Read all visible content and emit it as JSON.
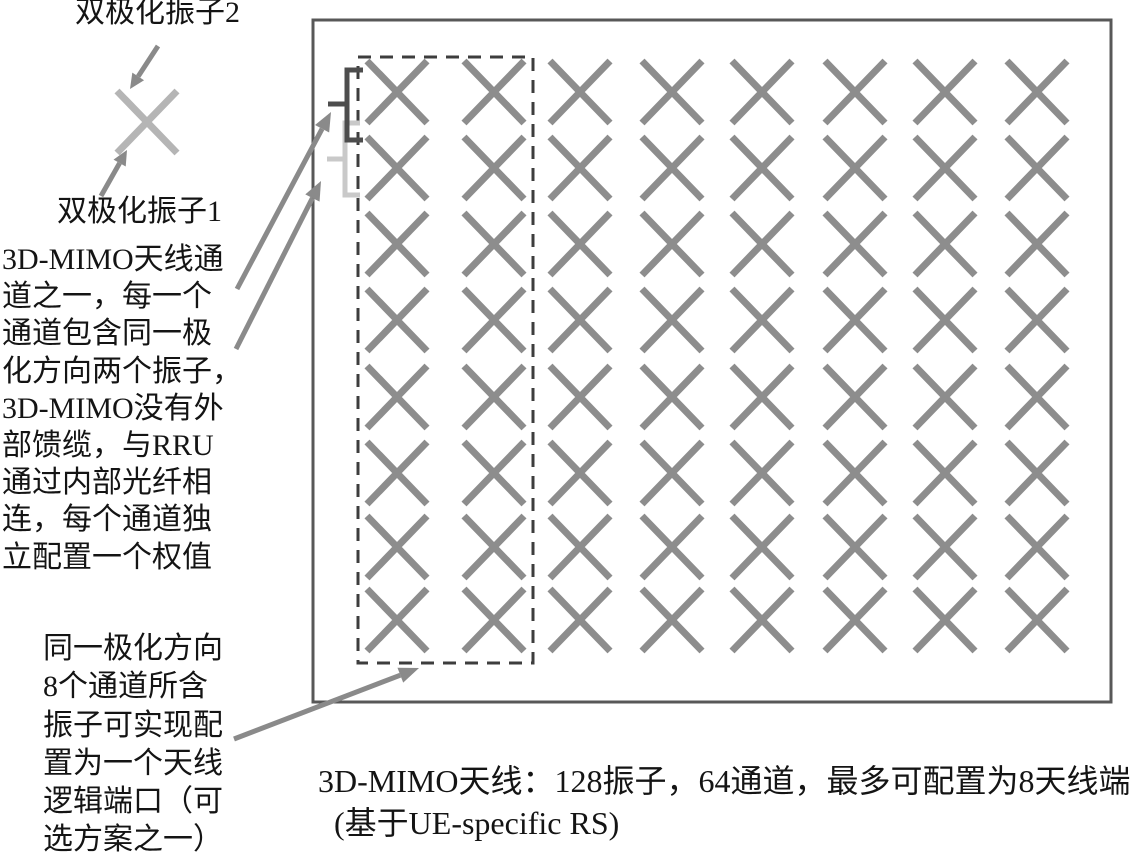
{
  "colors": {
    "text": "#141414",
    "panel_border": "#585858",
    "dashed_box": "#3d3d3d",
    "element_x": "#8d8d8d",
    "legend_x": "#b5b5b5",
    "arrow": "#8a8a8a",
    "bracket_dark": "#4d4d4d",
    "bracket_light": "#c9c9c9"
  },
  "legend": {
    "element2_label": "双极化振子2",
    "element1_label": "双极化振子1"
  },
  "left_note": {
    "lines": [
      "3D-MIMO天线通",
      "道之一，每一个",
      "通道包含同一极",
      "化方向两个振子，",
      "3D-MIMO没有外",
      "部馈缆，与RRU",
      "通过内部光纤相",
      "连，每个通道独",
      "立配置一个权值"
    ]
  },
  "bottom_left_note": {
    "lines": [
      "同一极化方向",
      "8个通道所含",
      "振子可实现配",
      "置为一个天线",
      "逻辑端口（可",
      "选方案之一）"
    ]
  },
  "caption": {
    "line1": "3D-MIMO天线：128振子，64通道，最多可配置为8天线端口",
    "line2": "(基于UE-specific RS)"
  },
  "array": {
    "rows": 8,
    "cols": 8
  }
}
